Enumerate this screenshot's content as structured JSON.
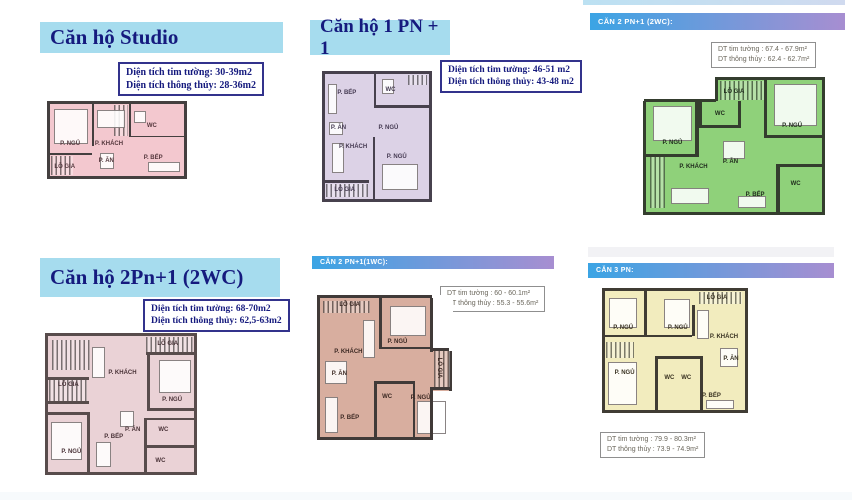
{
  "colors": {
    "header_blue_bg": "#a6dcee",
    "header_navy_text": "#151a7e",
    "gradient_bar_left": "#3ba4e4",
    "gradient_bar_right": "#a78ed1",
    "info_gray_text": "#6b675c"
  },
  "sections": [
    {
      "id": "studio",
      "header": {
        "label": "Căn hộ Studio",
        "style": "blue"
      },
      "info": {
        "line1": "Diện tích tim tường: 30-39m2",
        "line2": "Diện tích thông thủy: 28-36m2"
      },
      "plan": {
        "fill": "#f3c8cf",
        "wall": "#443f3f",
        "label_color": "#55383e",
        "cutouts": [],
        "hatches": [
          {
            "x": 48,
            "y": 2,
            "w": 10,
            "h": 42
          },
          {
            "x": 1,
            "y": 72,
            "w": 16,
            "h": 26
          }
        ],
        "furniture": [
          {
            "x": 3,
            "y": 7,
            "w": 25,
            "h": 48
          },
          {
            "x": 35,
            "y": 8,
            "w": 21,
            "h": 26
          },
          {
            "x": 37,
            "y": 68,
            "w": 11,
            "h": 22
          },
          {
            "x": 73,
            "y": 80,
            "w": 24,
            "h": 14
          },
          {
            "x": 63,
            "y": 10,
            "w": 9,
            "h": 16
          }
        ],
        "walls": [
          {
            "x": 31,
            "y": 0,
            "w": 1.8,
            "h": 58
          },
          {
            "x": 0,
            "y": 68,
            "w": 31,
            "h": 2.5
          },
          {
            "x": 59,
            "y": 0,
            "w": 1.8,
            "h": 46
          },
          {
            "x": 59,
            "y": 44,
            "w": 41,
            "h": 2.5
          }
        ],
        "rooms": [
          {
            "label": "P. NGỦ",
            "x": 15,
            "y": 56
          },
          {
            "label": "P. KHÁCH",
            "x": 44,
            "y": 56
          },
          {
            "label": "P. ĂN",
            "x": 42,
            "y": 79
          },
          {
            "label": "P. BẾP",
            "x": 77,
            "y": 75
          },
          {
            "label": "WC",
            "x": 76,
            "y": 30
          },
          {
            "label": "LÔ GIA",
            "x": 11,
            "y": 88
          }
        ]
      }
    },
    {
      "id": "1pn1",
      "header": {
        "label": "Căn hộ 1 PN + 1",
        "style": "blue"
      },
      "info": {
        "line1": "Diện tích tim tường: 46-51 m2",
        "line2": "Diện tích thông thủy: 43-48 m2"
      },
      "plan": {
        "fill": "#dcd2e6",
        "wall": "#47414d",
        "label_color": "#453a52",
        "cutouts": [],
        "hatches": [
          {
            "x": 1,
            "y": 88,
            "w": 40,
            "h": 10
          },
          {
            "x": 80,
            "y": 1,
            "w": 18,
            "h": 8
          }
        ],
        "furniture": [
          {
            "x": 3,
            "y": 8,
            "w": 9,
            "h": 24
          },
          {
            "x": 4,
            "y": 38,
            "w": 13,
            "h": 11
          },
          {
            "x": 7,
            "y": 55,
            "w": 11,
            "h": 24
          },
          {
            "x": 55,
            "y": 72,
            "w": 34,
            "h": 21
          },
          {
            "x": 55,
            "y": 4,
            "w": 11,
            "h": 12
          }
        ],
        "walls": [
          {
            "x": 47,
            "y": 0,
            "w": 2,
            "h": 27
          },
          {
            "x": 47,
            "y": 25,
            "w": 53,
            "h": 2
          },
          {
            "x": 46,
            "y": 50,
            "w": 2,
            "h": 50
          },
          {
            "x": 0,
            "y": 85,
            "w": 42,
            "h": 2
          }
        ],
        "rooms": [
          {
            "label": "P. BẾP",
            "x": 21,
            "y": 15
          },
          {
            "label": "WC",
            "x": 63,
            "y": 13
          },
          {
            "label": "P. ĂN",
            "x": 13,
            "y": 43
          },
          {
            "label": "P. NGỦ",
            "x": 61,
            "y": 43
          },
          {
            "label": "P. KHÁCH",
            "x": 27,
            "y": 58
          },
          {
            "label": "P. NGỦ",
            "x": 69,
            "y": 66
          },
          {
            "label": "LÔ GIA",
            "x": 19,
            "y": 93
          }
        ]
      }
    },
    {
      "id": "2pn1-2wc-green",
      "header": {
        "label": "CĂN 2 PN+1 (2WC):",
        "style": "grad"
      },
      "info": {
        "line1": "DT tim tường : 67.4 - 67.9m²",
        "line2": "DT thông thủy : 62.4 - 62.7m²"
      },
      "plan": {
        "fill": "#8fd17a",
        "wall": "#343d2e",
        "label_color": "#1f2a1c",
        "cutouts": [
          {
            "x": -2,
            "y": -3,
            "w": 42,
            "h": 19
          }
        ],
        "hatches": [
          {
            "x": 42,
            "y": 1,
            "w": 26,
            "h": 14
          },
          {
            "x": 2,
            "y": 58,
            "w": 9,
            "h": 39
          }
        ],
        "furniture": [
          {
            "x": 4,
            "y": 20,
            "w": 22,
            "h": 26
          },
          {
            "x": 73,
            "y": 3,
            "w": 24,
            "h": 32
          },
          {
            "x": 44,
            "y": 46,
            "w": 12,
            "h": 14
          },
          {
            "x": 14,
            "y": 82,
            "w": 22,
            "h": 12
          },
          {
            "x": 52,
            "y": 88,
            "w": 16,
            "h": 9
          }
        ],
        "walls": [
          {
            "x": -1,
            "y": 14.5,
            "w": 41,
            "h": 2.2
          },
          {
            "x": 39,
            "y": -2,
            "w": 2.2,
            "h": 18
          },
          {
            "x": 28,
            "y": 16,
            "w": 2,
            "h": 42
          },
          {
            "x": 0,
            "y": 56,
            "w": 30,
            "h": 2
          },
          {
            "x": 30,
            "y": 16,
            "w": 2,
            "h": 20
          },
          {
            "x": 30,
            "y": 34,
            "w": 24,
            "h": 2
          },
          {
            "x": 52,
            "y": 16,
            "w": 2,
            "h": 20
          },
          {
            "x": 67,
            "y": 0,
            "w": 2,
            "h": 44
          },
          {
            "x": 67,
            "y": 42,
            "w": 33,
            "h": 2
          },
          {
            "x": 74,
            "y": 64,
            "w": 2,
            "h": 36
          },
          {
            "x": 74,
            "y": 64,
            "w": 26,
            "h": 2
          }
        ],
        "rooms": [
          {
            "label": "LÔ GIA",
            "x": 50,
            "y": 9
          },
          {
            "label": "WC",
            "x": 42,
            "y": 26
          },
          {
            "label": "P. NGỦ",
            "x": 15,
            "y": 48
          },
          {
            "label": "P. NGỦ",
            "x": 83,
            "y": 35
          },
          {
            "label": "P. KHÁCH",
            "x": 27,
            "y": 66
          },
          {
            "label": "P. ĂN",
            "x": 48,
            "y": 62
          },
          {
            "label": "P. BẾP",
            "x": 62,
            "y": 87
          },
          {
            "label": "WC",
            "x": 85,
            "y": 79
          }
        ]
      }
    },
    {
      "id": "2pn1-2wc-pink",
      "header": {
        "label": "Căn hộ 2Pn+1 (2WC)",
        "style": "blue"
      },
      "info": {
        "line1": "Diện tích tim tường: 68-70m2",
        "line2": "Diện tích thông thủy: 62,5-63m2"
      },
      "plan": {
        "fill": "#ead2d6",
        "wall": "#584c4c",
        "label_color": "#4a3338",
        "cutouts": [],
        "hatches": [
          {
            "x": 3,
            "y": 3,
            "w": 26,
            "h": 22
          },
          {
            "x": 67,
            "y": 1,
            "w": 32,
            "h": 11
          },
          {
            "x": 1,
            "y": 32,
            "w": 26,
            "h": 16
          }
        ],
        "furniture": [
          {
            "x": 76,
            "y": 18,
            "w": 22,
            "h": 24
          },
          {
            "x": 2,
            "y": 63,
            "w": 21,
            "h": 28
          },
          {
            "x": 30,
            "y": 8,
            "w": 9,
            "h": 23
          },
          {
            "x": 49,
            "y": 55,
            "w": 10,
            "h": 12
          },
          {
            "x": 33,
            "y": 78,
            "w": 10,
            "h": 18
          }
        ],
        "walls": [
          {
            "x": 68,
            "y": 13,
            "w": 2,
            "h": 42
          },
          {
            "x": 68,
            "y": 53,
            "w": 32,
            "h": 2
          },
          {
            "x": 67,
            "y": 12,
            "w": 33,
            "h": 2
          },
          {
            "x": 0,
            "y": 30,
            "w": 28,
            "h": 2
          },
          {
            "x": 0,
            "y": 48,
            "w": 28,
            "h": 2
          },
          {
            "x": 27,
            "y": 58,
            "w": 2,
            "h": 42
          },
          {
            "x": 0,
            "y": 56,
            "w": 29,
            "h": 2
          },
          {
            "x": 66,
            "y": 60,
            "w": 2,
            "h": 40
          },
          {
            "x": 66,
            "y": 60,
            "w": 34,
            "h": 2
          },
          {
            "x": 66,
            "y": 80,
            "w": 34,
            "h": 2
          }
        ],
        "rooms": [
          {
            "label": "LÔ GIA",
            "x": 82,
            "y": 6
          },
          {
            "label": "P. KHÁCH",
            "x": 51,
            "y": 27
          },
          {
            "label": "LÔ GIA",
            "x": 14,
            "y": 36
          },
          {
            "label": "P. NGỦ",
            "x": 85,
            "y": 47
          },
          {
            "label": "P. ĂN",
            "x": 58,
            "y": 69
          },
          {
            "label": "P. BẾP",
            "x": 45,
            "y": 74
          },
          {
            "label": "WC",
            "x": 79,
            "y": 69
          },
          {
            "label": "P. NGỦ",
            "x": 16,
            "y": 85
          },
          {
            "label": "WC",
            "x": 77,
            "y": 92
          }
        ]
      }
    },
    {
      "id": "2pn1-1wc",
      "header": {
        "label": "CĂN 2 PN+1(1WC):",
        "style": "grad"
      },
      "info": {
        "line1": "DT tim tường : 60 - 60.1m²",
        "line2": "DT thông thủy : 55.3 - 55.6m²"
      },
      "plan": {
        "fill": "#d8ae9f",
        "wall": "#403a38",
        "label_color": "#3d2a24",
        "cutouts": [
          {
            "x": 87,
            "y": -2,
            "w": 16,
            "h": 40
          },
          {
            "x": 87,
            "y": 67,
            "w": 16,
            "h": 36
          }
        ],
        "hatches": [
          {
            "x": 2,
            "y": 2,
            "w": 37,
            "h": 9
          },
          {
            "x": 88,
            "y": 38,
            "w": 13,
            "h": 26
          }
        ],
        "furniture": [
          {
            "x": 54,
            "y": 6,
            "w": 28,
            "h": 21
          },
          {
            "x": 33,
            "y": 16,
            "w": 10,
            "h": 27
          },
          {
            "x": 4,
            "y": 45,
            "w": 17,
            "h": 17
          },
          {
            "x": 75,
            "y": 74,
            "w": 23,
            "h": 24
          },
          {
            "x": 4,
            "y": 71,
            "w": 10,
            "h": 26
          }
        ],
        "walls": [
          {
            "x": 85,
            "y": 0,
            "w": 2.3,
            "h": 39
          },
          {
            "x": 85,
            "y": 66,
            "w": 2.3,
            "h": 36
          },
          {
            "x": 85,
            "y": 36,
            "w": 15,
            "h": 2
          },
          {
            "x": 85,
            "y": 64,
            "w": 15,
            "h": 2
          },
          {
            "x": 46,
            "y": 0,
            "w": 2,
            "h": 37
          },
          {
            "x": 46,
            "y": 35,
            "w": 41,
            "h": 2
          },
          {
            "x": 42,
            "y": 60,
            "w": 2,
            "h": 40
          },
          {
            "x": 42,
            "y": 60,
            "w": 32,
            "h": 2
          },
          {
            "x": 72,
            "y": 60,
            "w": 2,
            "h": 40
          }
        ],
        "rooms": [
          {
            "label": "LÔ GIA",
            "x": 23,
            "y": 5
          },
          {
            "label": "P. NGỦ",
            "x": 60,
            "y": 32
          },
          {
            "label": "P. KHÁCH",
            "x": 22,
            "y": 39
          },
          {
            "label": "P. ĂN",
            "x": 15,
            "y": 55
          },
          {
            "label": "LÔ GIA",
            "x": 92,
            "y": 50,
            "rot": true
          },
          {
            "label": "WC",
            "x": 52,
            "y": 71
          },
          {
            "label": "P. NGỦ",
            "x": 78,
            "y": 72
          },
          {
            "label": "P. BẾP",
            "x": 23,
            "y": 86
          }
        ]
      }
    },
    {
      "id": "3pn",
      "header": {
        "label": "CĂN 3 PN:",
        "style": "grad"
      },
      "info": {
        "line1": "DT tim tường : 79.9 - 80.3m²",
        "line2": "DT thông thủy : 73.9 - 74.9m²"
      },
      "plan": {
        "fill": "#f2ecbe",
        "wall": "#403c34",
        "label_color": "#3a3322",
        "cutouts": [],
        "hatches": [
          {
            "x": 67,
            "y": 1,
            "w": 31,
            "h": 10
          },
          {
            "x": 1,
            "y": 43,
            "w": 20,
            "h": 13
          }
        ],
        "furniture": [
          {
            "x": 3,
            "y": 6,
            "w": 20,
            "h": 25
          },
          {
            "x": 42,
            "y": 7,
            "w": 19,
            "h": 24
          },
          {
            "x": 2,
            "y": 60,
            "w": 21,
            "h": 36
          },
          {
            "x": 82,
            "y": 48,
            "w": 13,
            "h": 16
          },
          {
            "x": 66,
            "y": 16,
            "w": 8,
            "h": 24
          },
          {
            "x": 72,
            "y": 92,
            "w": 20,
            "h": 7
          }
        ],
        "walls": [
          {
            "x": 28,
            "y": 0,
            "w": 2,
            "h": 38
          },
          {
            "x": 0,
            "y": 37,
            "w": 62,
            "h": 2
          },
          {
            "x": 62,
            "y": 12,
            "w": 2,
            "h": 26
          },
          {
            "x": 36,
            "y": 55,
            "w": 2,
            "h": 45
          },
          {
            "x": 36,
            "y": 55,
            "w": 34,
            "h": 2
          },
          {
            "x": 68,
            "y": 55,
            "w": 2,
            "h": 45
          }
        ],
        "rooms": [
          {
            "label": "P. NGỦ",
            "x": 13,
            "y": 31
          },
          {
            "label": "P. NGỦ",
            "x": 52,
            "y": 31
          },
          {
            "label": "LÔ GIA",
            "x": 80,
            "y": 6
          },
          {
            "label": "P. KHÁCH",
            "x": 85,
            "y": 39
          },
          {
            "label": "P. ĂN",
            "x": 90,
            "y": 57
          },
          {
            "label": "P. NGỦ",
            "x": 14,
            "y": 69
          },
          {
            "label": "WC",
            "x": 46,
            "y": 73
          },
          {
            "label": "WC",
            "x": 58,
            "y": 73
          },
          {
            "label": "P. BẾP",
            "x": 76,
            "y": 88
          }
        ]
      }
    }
  ]
}
